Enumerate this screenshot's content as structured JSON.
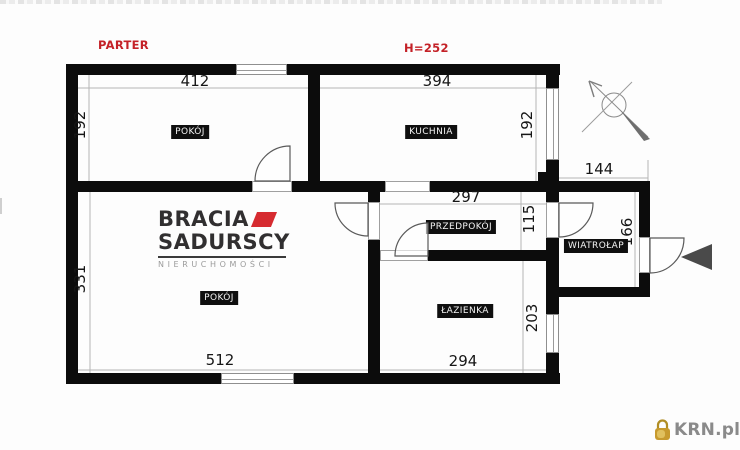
{
  "header": {
    "floor_label": "PARTER",
    "ceiling_height": "H=252"
  },
  "rooms": {
    "pokoj_top": "POKÓJ",
    "kuchnia": "KUCHNIA",
    "pokoj_bottom": "POKÓJ",
    "przedpokoj": "PRZEDPOKÓJ",
    "lazienka": "ŁAZIENKA",
    "wiatrolap": "WIATROŁAP"
  },
  "dims": {
    "pokoj_top_w": "412",
    "kuchnia_w": "394",
    "pokoj_top_h": "192",
    "kuchnia_h": "192",
    "przedpokoj_w": "297",
    "przedpokoj_h": "115",
    "wiatrolap_w": "144",
    "wiatrolap_h": "166",
    "lazienka_h": "203",
    "lazienka_w": "294",
    "pokoj_bottom_h": "331",
    "pokoj_bottom_w": "512"
  },
  "branding": {
    "name_line1": "BRACIA",
    "name_line2": "SADURSCY",
    "tagline": "NIERUCHOMOŚCI"
  },
  "watermark": {
    "site_name": "KRN.pl"
  },
  "icons": {
    "compass": "north-arrow-compass-icon",
    "entrance": "entrance-arrow-icon",
    "padlock": "gold-padlock-icon"
  },
  "colors": {
    "accent_red": "#c42127",
    "logo_red": "#d62b30",
    "wall_black": "#0c0c0c",
    "watermark_gray": "#8a8a8a",
    "watermark_gold": "#c79a2e"
  }
}
